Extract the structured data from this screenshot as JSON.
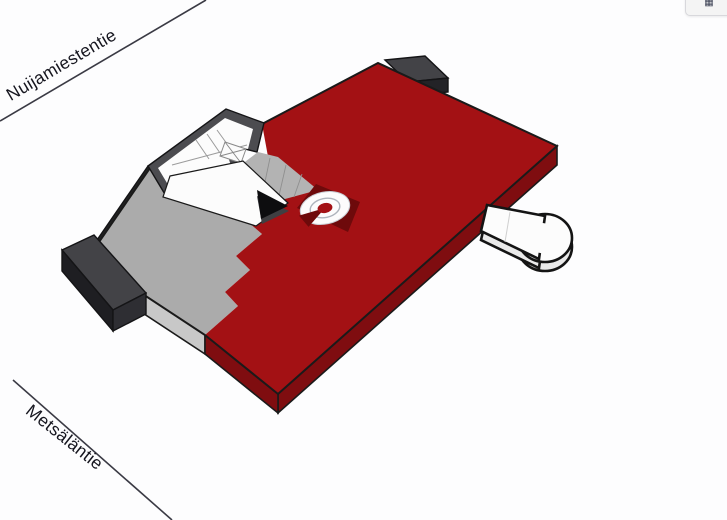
{
  "streets": {
    "top": {
      "name": "Nuijamiestentie"
    },
    "bottom": {
      "name": "Metsäläntie"
    }
  },
  "controls": {
    "corner_button_glyph": "▦"
  },
  "icons": {
    "corner_button": "grid-icon",
    "marker": "location-radar-icon",
    "route": "route-arrowhead-icon"
  },
  "colors": {
    "street_line": "#3a3a44",
    "street_text": "#16161f",
    "roof_red": "#a31114",
    "side_red": "#7f0d10",
    "roof_gray": "#ababab",
    "side_gray": "#c8c8c8",
    "wall_dark": "#4c4c50",
    "wall_darker": "#232327",
    "nw_wall": "#232323",
    "block_top": "#434347",
    "block_left": "#1e1e22",
    "block_right": "#2e2e33",
    "white": "#fcfcfc",
    "canopy_side": "#e9e9e9",
    "marker_patch": "#6e0a0b",
    "marker_center": "#a31114",
    "arrow_black": "#0d0d0f",
    "arrow_under": "#3f3f42",
    "strip_gray": "#b3b3b3"
  }
}
